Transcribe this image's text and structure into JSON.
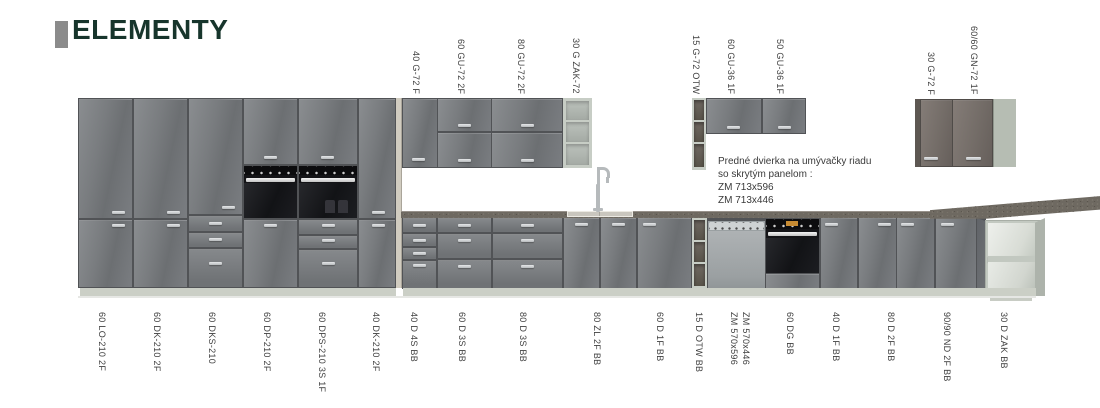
{
  "brand": {
    "title": "ELEMENTY"
  },
  "note": {
    "lines": [
      "Predné dvierka na umývačky riadu",
      "so skrytým panelom :",
      "ZM 713x596",
      "ZM 713x446"
    ]
  },
  "labels": {
    "top": [
      "40 G-72 F",
      "60 GU-72 2F",
      "80 GU-72 2F",
      "30 G ZAK-72",
      "15 G-72 OTW",
      "60 GU-36 1F",
      "50 GU-36 1F",
      "30 G-72 F",
      "60/60 GN-72 1F"
    ],
    "bottom": [
      "60 LO-210 2F",
      "60 DK-210 2F",
      "60 DKS-210",
      "60 DP-210 2F",
      "60 DPS-210 3S 1F",
      "40 DK-210 2F",
      "40 D 4S BB",
      "60 D 3S BB",
      "80 D 3S BB",
      "80 ZL 2F BB",
      "60 D 1F BB",
      "15 D OTW BB",
      "ZM 570x596",
      "ZM 570x446",
      "60 DG BB",
      "40 D 1F BB",
      "80 D 2F BB",
      "90/90 ND 2F BB",
      "30 D ZAK BB"
    ]
  },
  "colors": {
    "logo_green": "#17352c",
    "cabinet_gray": "#75787b",
    "cabinet_taupe": "#746d68",
    "carcass_light": "#c7cdc5",
    "countertop": "#6e6961",
    "oven_black": "#141417"
  }
}
